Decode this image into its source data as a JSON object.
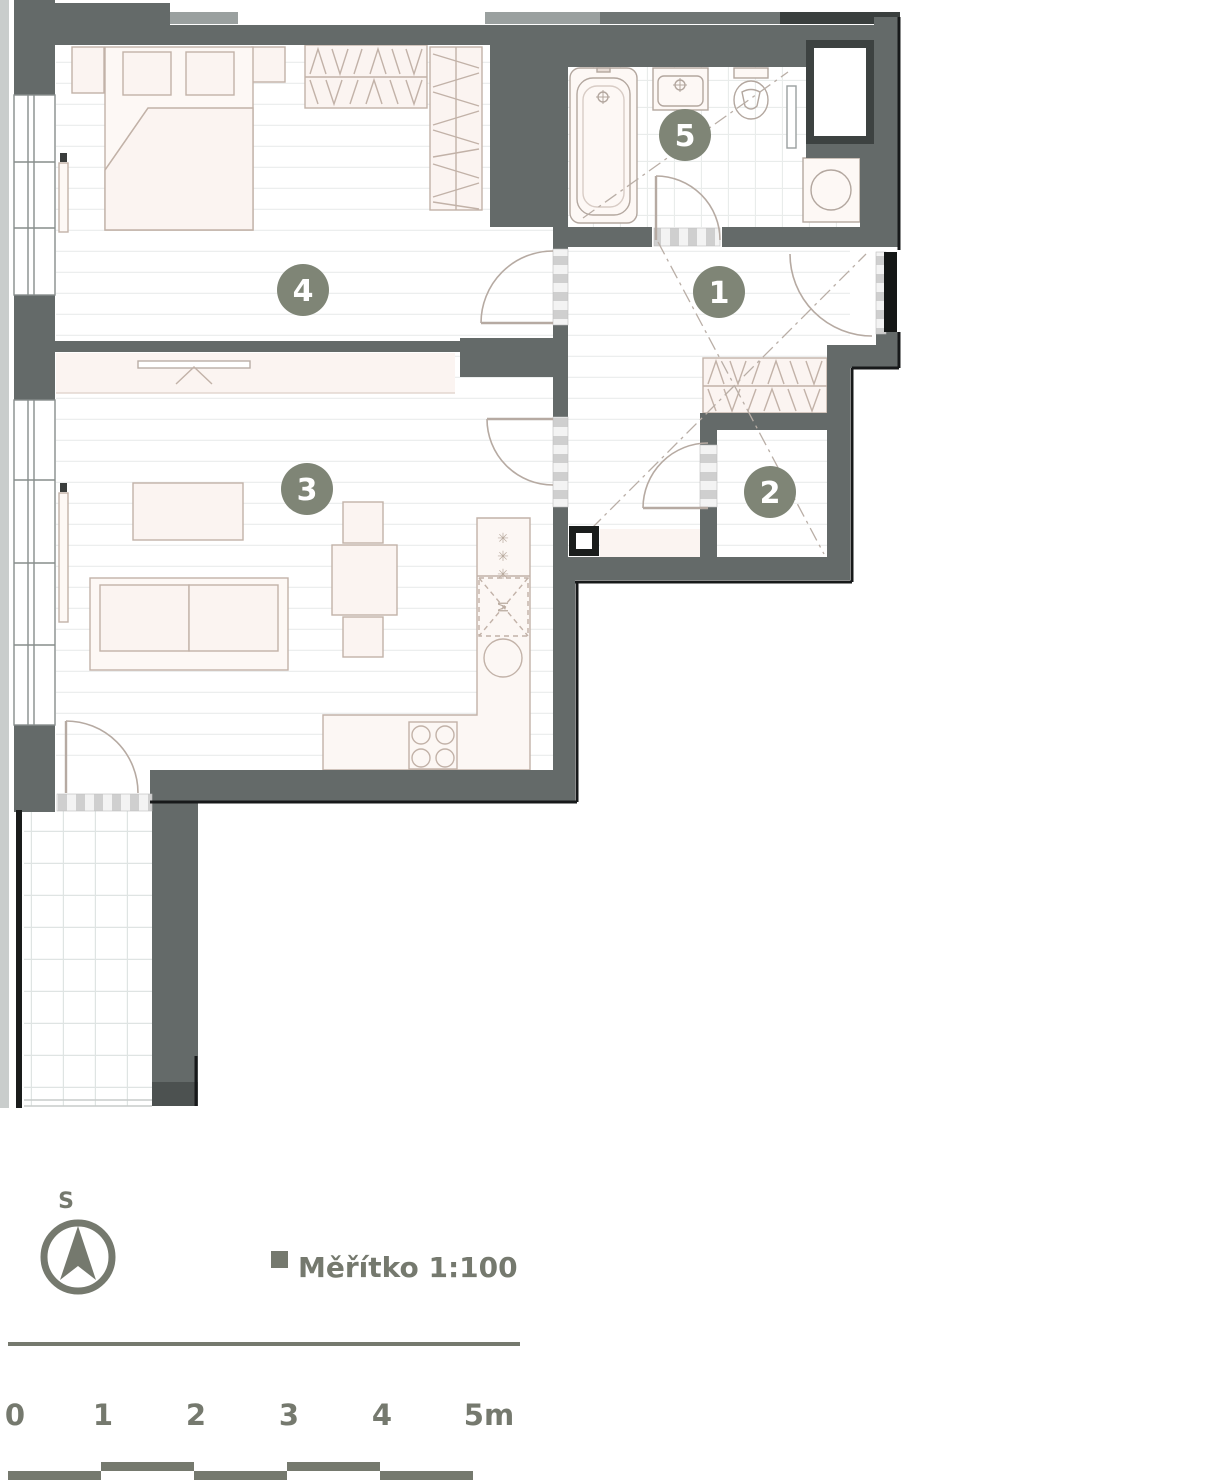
{
  "plan": {
    "room_badges": [
      {
        "room": "entrance-hall",
        "number": "1"
      },
      {
        "room": "closet",
        "number": "2"
      },
      {
        "room": "living-room-kitchen",
        "number": "3"
      },
      {
        "room": "bedroom",
        "number": "4"
      },
      {
        "room": "bathroom",
        "number": "5"
      }
    ],
    "kitchen_appliance_label": "M",
    "fridge_symbol": "✳",
    "colors": {
      "wall": "#646a69",
      "badge": "#7f8576",
      "legend": "#75796e",
      "furniture_stroke": "#c2b2a8",
      "furniture_fill": "#fbf4f1"
    }
  },
  "legend": {
    "compass_direction_label": "S",
    "scale_label": "Měřítko 1:100",
    "scale_ticks": [
      "0",
      "1",
      "2",
      "3",
      "4",
      "5m"
    ]
  }
}
